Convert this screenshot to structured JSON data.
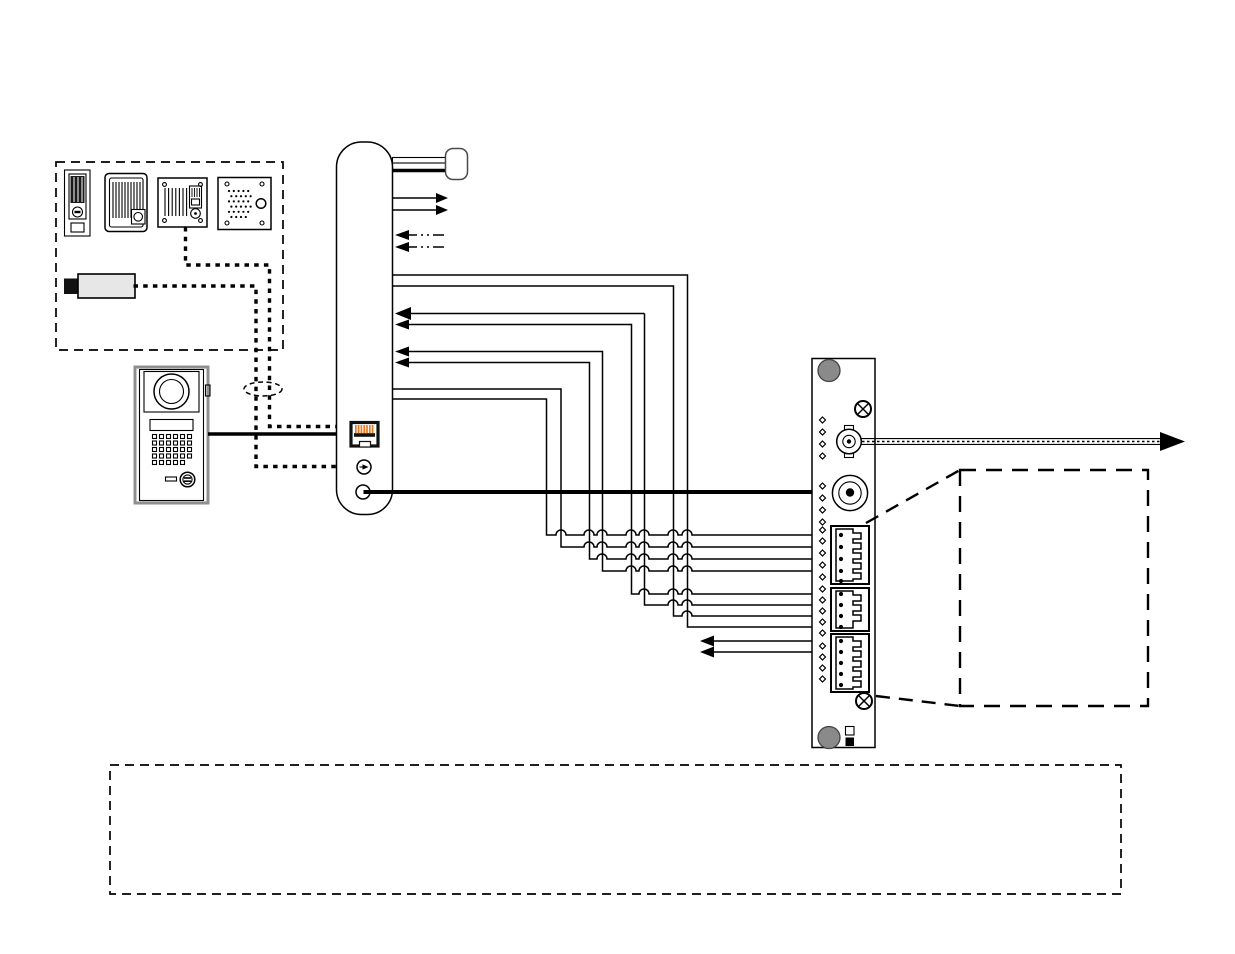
{
  "colors": {
    "ink": "#000000",
    "white": "#ffffff",
    "hole_gray": "#8a8a8a",
    "module_fill": "#e7e7e7",
    "rj45_orange": "#e87c1e",
    "plug_border": "#4a4a4a"
  },
  "diagram": {
    "type": "installation-wiring-diagram",
    "accessory_box_items": [
      "compact-station-icon",
      "audio-station-icon",
      "flush-station-icon",
      "speaker-station-icon",
      "line-interface-module-icon"
    ],
    "door_station": "video-door-station-icon",
    "main_unit": "master-unit-side-profile",
    "panel": {
      "terminal_blocks": 3,
      "pins_per_block": [
        5,
        4,
        5
      ],
      "screws": 2,
      "mounting_holes": 2,
      "connectors": [
        "bnc-video-connector",
        "round-power-connector"
      ]
    },
    "wires": {
      "station_lines": 8,
      "dashed_option_lines": 2,
      "relay_out_lines": 2
    }
  }
}
